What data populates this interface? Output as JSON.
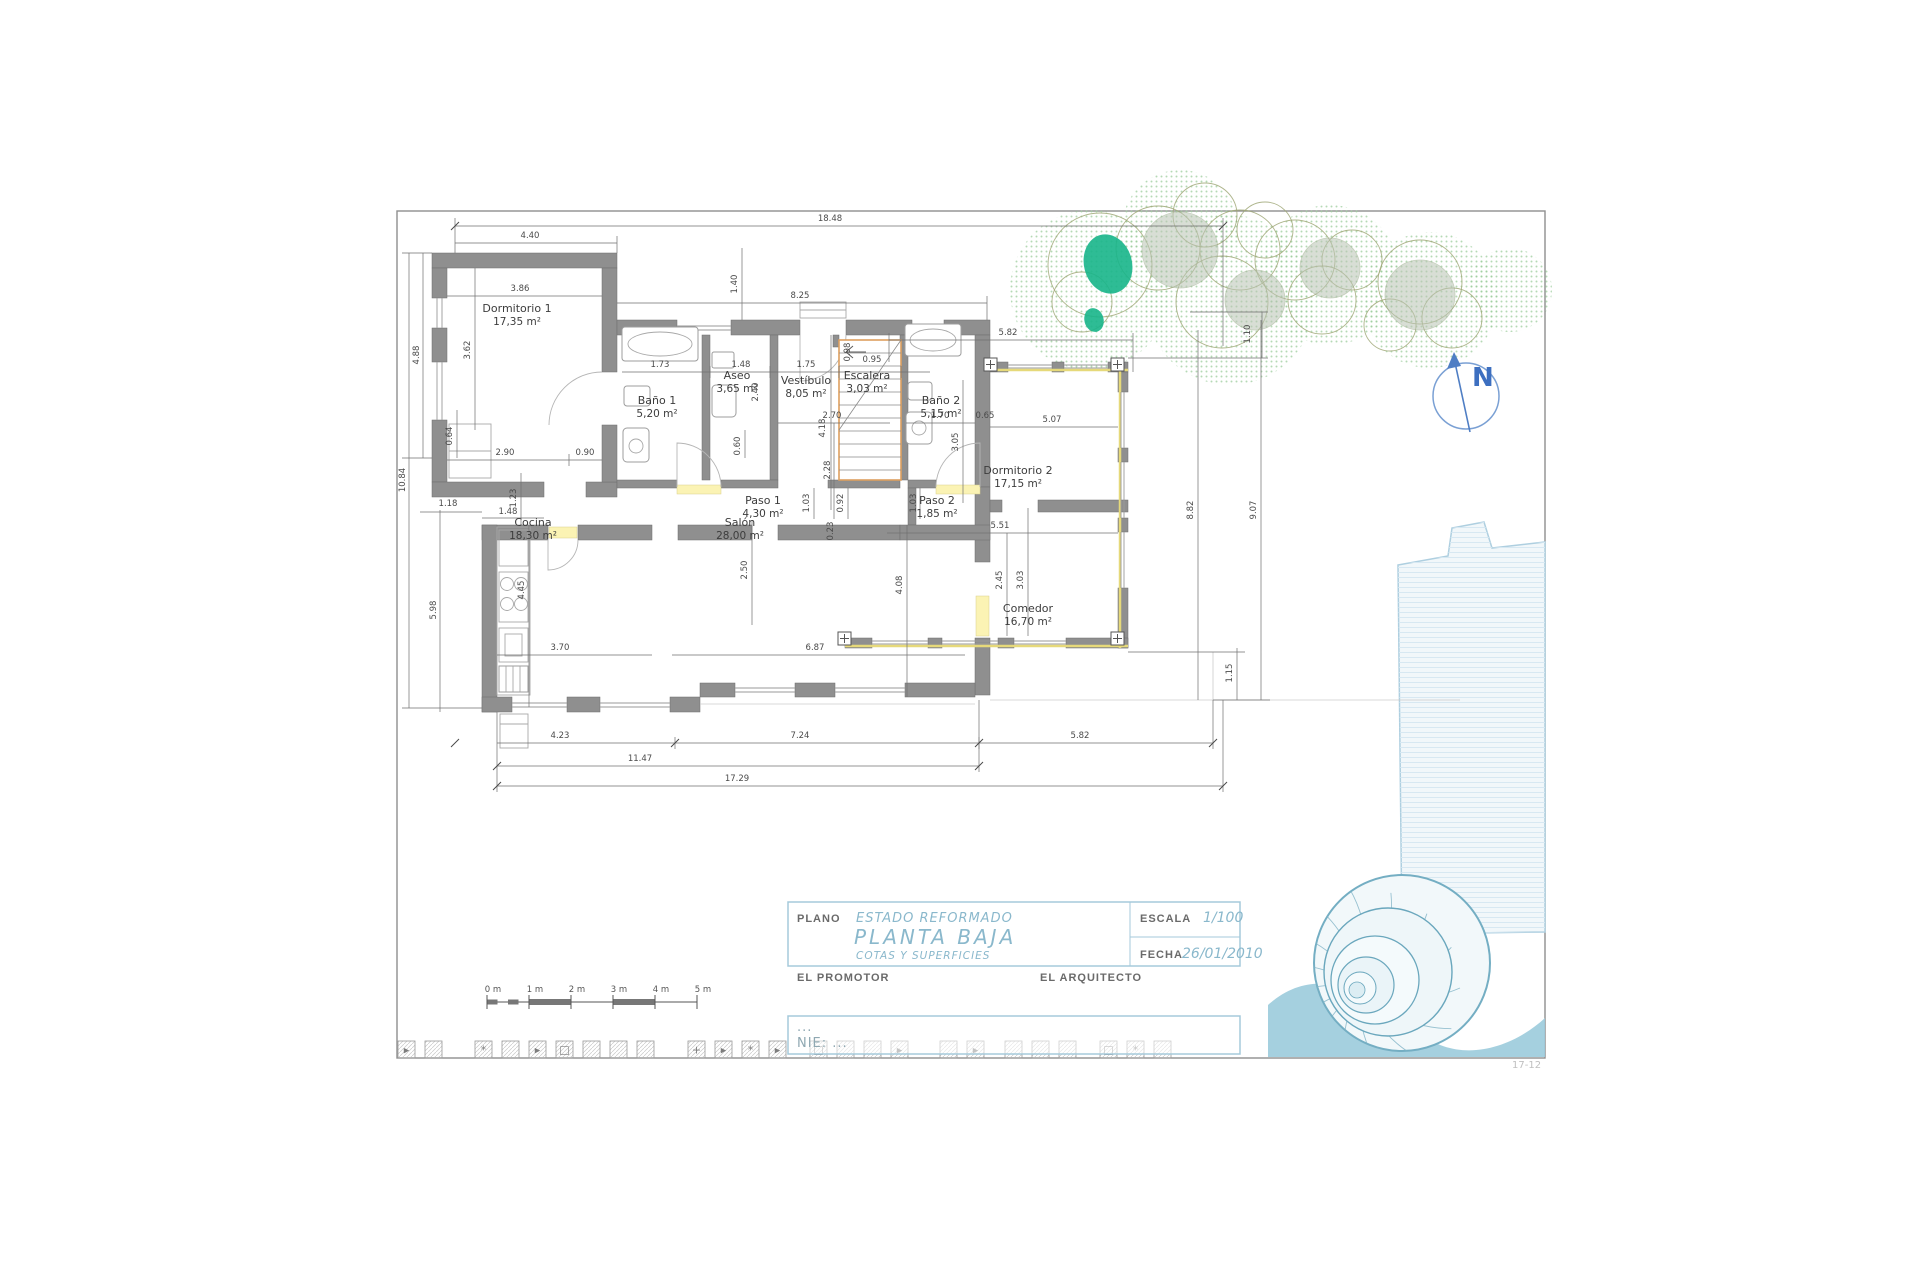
{
  "meta": {
    "sheet_note": "17-12"
  },
  "colors": {
    "wall": "#8f8f8f",
    "dim_text": "#4a4a4a",
    "accent_blue": "#8ab8cc",
    "title_border": "#a5cadb",
    "north_blue": "#3d6fc0",
    "tree_green": "#9ccc9c",
    "teal_accent": "#17b58a",
    "nautilus": "#7fb3c6",
    "stair_orange": "#dd9f5f",
    "threshold_yellow": "#fbf3b4"
  },
  "rooms": [
    {
      "name": "Dormitorio 1",
      "area": "17,35 m²",
      "x": 517,
      "y": 312
    },
    {
      "name": "Baño 1",
      "area": "5,20 m²",
      "x": 657,
      "y": 404
    },
    {
      "name": "Aseo",
      "area": "3,65 m²",
      "x": 737,
      "y": 379
    },
    {
      "name": "Vestíbulo",
      "area": "8,05 m²",
      "x": 806,
      "y": 384
    },
    {
      "name": "Escalera",
      "area": "3,03 m²",
      "x": 867,
      "y": 379
    },
    {
      "name": "Baño 2",
      "area": "5,15 m²",
      "x": 941,
      "y": 404
    },
    {
      "name": "Paso 1",
      "area": "4,30 m²",
      "x": 763,
      "y": 504
    },
    {
      "name": "Paso 2",
      "area": "1,85 m²",
      "x": 937,
      "y": 504
    },
    {
      "name": "Dormitorio 2",
      "area": "17,15 m²",
      "x": 1018,
      "y": 474
    },
    {
      "name": "Cocina",
      "area": "18,30 m²",
      "x": 533,
      "y": 526
    },
    {
      "name": "Salón",
      "area": "28,00 m²",
      "x": 740,
      "y": 526
    },
    {
      "name": "Comedor",
      "area": "16,70 m²",
      "x": 1028,
      "y": 612
    }
  ],
  "dims": [
    {
      "v": "18.48",
      "x": 830,
      "y": 221,
      "r": 0
    },
    {
      "v": "4.40",
      "x": 530,
      "y": 238,
      "r": 0
    },
    {
      "v": "3.86",
      "x": 520,
      "y": 291,
      "r": 0
    },
    {
      "v": "8.25",
      "x": 800,
      "y": 298,
      "r": 0
    },
    {
      "v": "5.82",
      "x": 1008,
      "y": 335,
      "r": 0
    },
    {
      "v": "2.90",
      "x": 505,
      "y": 455,
      "r": 0
    },
    {
      "v": "0.90",
      "x": 585,
      "y": 455,
      "r": 0
    },
    {
      "v": "1.18",
      "x": 448,
      "y": 506,
      "r": 0
    },
    {
      "v": "1.48",
      "x": 508,
      "y": 514,
      "r": 0
    },
    {
      "v": "1.73",
      "x": 660,
      "y": 367,
      "r": 0
    },
    {
      "v": "1.48",
      "x": 741,
      "y": 367,
      "r": 0
    },
    {
      "v": "1.75",
      "x": 806,
      "y": 367,
      "r": 0
    },
    {
      "v": "0.95",
      "x": 872,
      "y": 362,
      "r": 0
    },
    {
      "v": "2.70",
      "x": 832,
      "y": 418,
      "r": 0
    },
    {
      "v": "1.70",
      "x": 940,
      "y": 418,
      "r": 0
    },
    {
      "v": "0.65",
      "x": 985,
      "y": 418,
      "r": 0
    },
    {
      "v": "5.07",
      "x": 1052,
      "y": 422,
      "r": 0
    },
    {
      "v": "5.51",
      "x": 1000,
      "y": 528,
      "r": 0
    },
    {
      "v": "3.70",
      "x": 560,
      "y": 650,
      "r": 0
    },
    {
      "v": "6.87",
      "x": 815,
      "y": 650,
      "r": 0
    },
    {
      "v": "4.23",
      "x": 560,
      "y": 738,
      "r": 0
    },
    {
      "v": "7.24",
      "x": 800,
      "y": 738,
      "r": 0
    },
    {
      "v": "5.82",
      "x": 1080,
      "y": 738,
      "r": 0
    },
    {
      "v": "11.47",
      "x": 640,
      "y": 761,
      "r": 0
    },
    {
      "v": "17.29",
      "x": 737,
      "y": 781,
      "r": 0
    },
    {
      "v": "4.88",
      "x": 419,
      "y": 355,
      "r": -90
    },
    {
      "v": "10.84",
      "x": 405,
      "y": 480,
      "r": -90
    },
    {
      "v": "3.62",
      "x": 470,
      "y": 350,
      "r": -90
    },
    {
      "v": "0.64",
      "x": 452,
      "y": 436,
      "r": -90
    },
    {
      "v": "5.98",
      "x": 436,
      "y": 610,
      "r": -90
    },
    {
      "v": "1.23",
      "x": 516,
      "y": 498,
      "r": -90
    },
    {
      "v": "1.40",
      "x": 737,
      "y": 284,
      "r": -90
    },
    {
      "v": "0.98",
      "x": 850,
      "y": 352,
      "r": -90
    },
    {
      "v": "2.40",
      "x": 758,
      "y": 392,
      "r": -90
    },
    {
      "v": "0.60",
      "x": 740,
      "y": 446,
      "r": -90
    },
    {
      "v": "4.18",
      "x": 825,
      "y": 428,
      "r": -90
    },
    {
      "v": "2.28",
      "x": 830,
      "y": 470,
      "r": -90
    },
    {
      "v": "0.92",
      "x": 843,
      "y": 503,
      "r": -90
    },
    {
      "v": "1.03",
      "x": 809,
      "y": 503,
      "r": -90
    },
    {
      "v": "1.03",
      "x": 916,
      "y": 503,
      "r": -90
    },
    {
      "v": "0.23",
      "x": 833,
      "y": 531,
      "r": -90
    },
    {
      "v": "2.50",
      "x": 747,
      "y": 570,
      "r": -90
    },
    {
      "v": "4.08",
      "x": 902,
      "y": 585,
      "r": -90
    },
    {
      "v": "4.45",
      "x": 524,
      "y": 590,
      "r": -90
    },
    {
      "v": "3.05",
      "x": 958,
      "y": 442,
      "r": -90
    },
    {
      "v": "2.45",
      "x": 1002,
      "y": 580,
      "r": -90
    },
    {
      "v": "3.03",
      "x": 1023,
      "y": 580,
      "r": -90
    },
    {
      "v": "1.10",
      "x": 1250,
      "y": 334,
      "r": -90
    },
    {
      "v": "8.82",
      "x": 1193,
      "y": 510,
      "r": -90
    },
    {
      "v": "9.07",
      "x": 1256,
      "y": 510,
      "r": -90
    },
    {
      "v": "1.15",
      "x": 1232,
      "y": 673,
      "r": -90
    }
  ],
  "scale_bar": {
    "x": 487,
    "y": 1002,
    "px_per_m": 42,
    "labels": [
      "0 m",
      "1 m",
      "2 m",
      "3 m",
      "4 m",
      "5 m"
    ],
    "filled_segments": [
      [
        1,
        2
      ],
      [
        3,
        4
      ]
    ]
  },
  "north": {
    "label": "N"
  },
  "title_block": {
    "plano_label": "PLANO",
    "plano_line1": "ESTADO REFORMADO",
    "plano_line2": "PLANTA BAJA",
    "plano_line3": "COTAS Y SUPERFICIES",
    "escala_label": "ESCALA",
    "escala_value": "1/100",
    "fecha_label": "FECHA",
    "fecha_value": "26/01/2010",
    "promotor_label": "EL PROMOTOR",
    "arquitecto_label": "EL ARQUITECTO",
    "nie_line1": "...",
    "nie_line2": "NIE:  ..."
  },
  "trees": [
    {
      "cx": 1090,
      "cy": 290,
      "r": 80,
      "kind": "blob"
    },
    {
      "cx": 1230,
      "cy": 300,
      "r": 85,
      "kind": "blob"
    },
    {
      "cx": 1330,
      "cy": 275,
      "r": 70,
      "kind": "blob"
    },
    {
      "cx": 1430,
      "cy": 300,
      "r": 68,
      "kind": "blob"
    },
    {
      "cx": 1180,
      "cy": 228,
      "r": 58,
      "kind": "blob"
    },
    {
      "cx": 1510,
      "cy": 290,
      "r": 42,
      "kind": "blob"
    },
    {
      "cx": 1100,
      "cy": 265,
      "r": 52,
      "kind": "line"
    },
    {
      "cx": 1082,
      "cy": 302,
      "r": 30,
      "kind": "line"
    },
    {
      "cx": 1158,
      "cy": 248,
      "r": 42,
      "kind": "line"
    },
    {
      "cx": 1205,
      "cy": 215,
      "r": 32,
      "kind": "line"
    },
    {
      "cx": 1240,
      "cy": 250,
      "r": 40,
      "kind": "line"
    },
    {
      "cx": 1222,
      "cy": 302,
      "r": 46,
      "kind": "line"
    },
    {
      "cx": 1295,
      "cy": 260,
      "r": 40,
      "kind": "line"
    },
    {
      "cx": 1322,
      "cy": 300,
      "r": 34,
      "kind": "line"
    },
    {
      "cx": 1352,
      "cy": 260,
      "r": 30,
      "kind": "line"
    },
    {
      "cx": 1420,
      "cy": 282,
      "r": 42,
      "kind": "line"
    },
    {
      "cx": 1452,
      "cy": 318,
      "r": 30,
      "kind": "line"
    },
    {
      "cx": 1390,
      "cy": 325,
      "r": 26,
      "kind": "line"
    },
    {
      "cx": 1265,
      "cy": 230,
      "r": 28,
      "kind": "line"
    },
    {
      "cx": 1180,
      "cy": 250,
      "r": 38,
      "kind": "shade"
    },
    {
      "cx": 1255,
      "cy": 300,
      "r": 30,
      "kind": "shade"
    },
    {
      "cx": 1420,
      "cy": 295,
      "r": 35,
      "kind": "shade"
    },
    {
      "cx": 1330,
      "cy": 268,
      "r": 30,
      "kind": "shade"
    },
    {
      "cx": 1108,
      "cy": 264,
      "r": 30,
      "kind": "solid"
    },
    {
      "cx": 1094,
      "cy": 320,
      "r": 12,
      "kind": "solid"
    }
  ],
  "icons_strip": {
    "y": 1041,
    "size": 17,
    "items": [
      {
        "x": 398,
        "g": "tr"
      },
      {
        "x": 425,
        "g": "h"
      },
      {
        "x": 475,
        "g": "as"
      },
      {
        "x": 502,
        "g": "h"
      },
      {
        "x": 529,
        "g": "tr"
      },
      {
        "x": 556,
        "g": "sq"
      },
      {
        "x": 583,
        "g": "h"
      },
      {
        "x": 610,
        "g": "h"
      },
      {
        "x": 637,
        "g": "h"
      },
      {
        "x": 688,
        "g": "cr"
      },
      {
        "x": 715,
        "g": "tr"
      },
      {
        "x": 742,
        "g": "as"
      },
      {
        "x": 769,
        "g": "tr"
      },
      {
        "x": 810,
        "g": "sq"
      },
      {
        "x": 837,
        "g": "h"
      },
      {
        "x": 864,
        "g": "h"
      },
      {
        "x": 891,
        "g": "tr"
      },
      {
        "x": 940,
        "g": "h"
      },
      {
        "x": 967,
        "g": "tr"
      },
      {
        "x": 1005,
        "g": "h"
      },
      {
        "x": 1032,
        "g": "h"
      },
      {
        "x": 1059,
        "g": "h"
      },
      {
        "x": 1100,
        "g": "sq"
      },
      {
        "x": 1127,
        "g": "as"
      },
      {
        "x": 1154,
        "g": "h"
      }
    ]
  }
}
